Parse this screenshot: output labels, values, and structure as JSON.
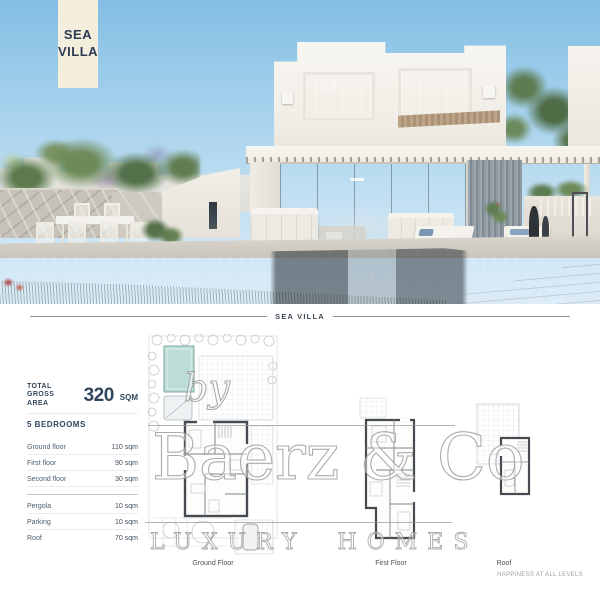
{
  "banner": {
    "line1": "SEA",
    "line2": "VILLA"
  },
  "divider": {
    "label": "SEA VILLA"
  },
  "specs": {
    "total_label_line1": "TOTAL",
    "total_label_line2": "GROSS AREA",
    "total_value": "320",
    "total_unit": "SQM",
    "bedrooms": "5 BEDROOMS",
    "floors": [
      {
        "label": "Ground floor",
        "value": "110 sqm"
      },
      {
        "label": "First floor",
        "value": "90 sqm"
      },
      {
        "label": "Second floor",
        "value": "30 sqm"
      }
    ],
    "extras": [
      {
        "label": "Pergola",
        "value": "10 sqm"
      },
      {
        "label": "Parking",
        "value": "10 sqm"
      },
      {
        "label": "Roof",
        "value": "70 sqm"
      }
    ]
  },
  "plans": [
    {
      "label": "Ground Floor"
    },
    {
      "label": "First Floor"
    },
    {
      "label": "Roof"
    }
  ],
  "watermark": {
    "by": "by",
    "brand": "Baerz & Co",
    "tagline": "LUXURY HOMES"
  },
  "footer": {
    "slogan": "HAPPINESS AT ALL LEVELS"
  },
  "colors": {
    "accent_navy": "#2e3b55",
    "banner_cream": "#f3efdc",
    "pool_plan_teal": "#bcdcd6",
    "watermark_gray": "#9b9b9b"
  }
}
